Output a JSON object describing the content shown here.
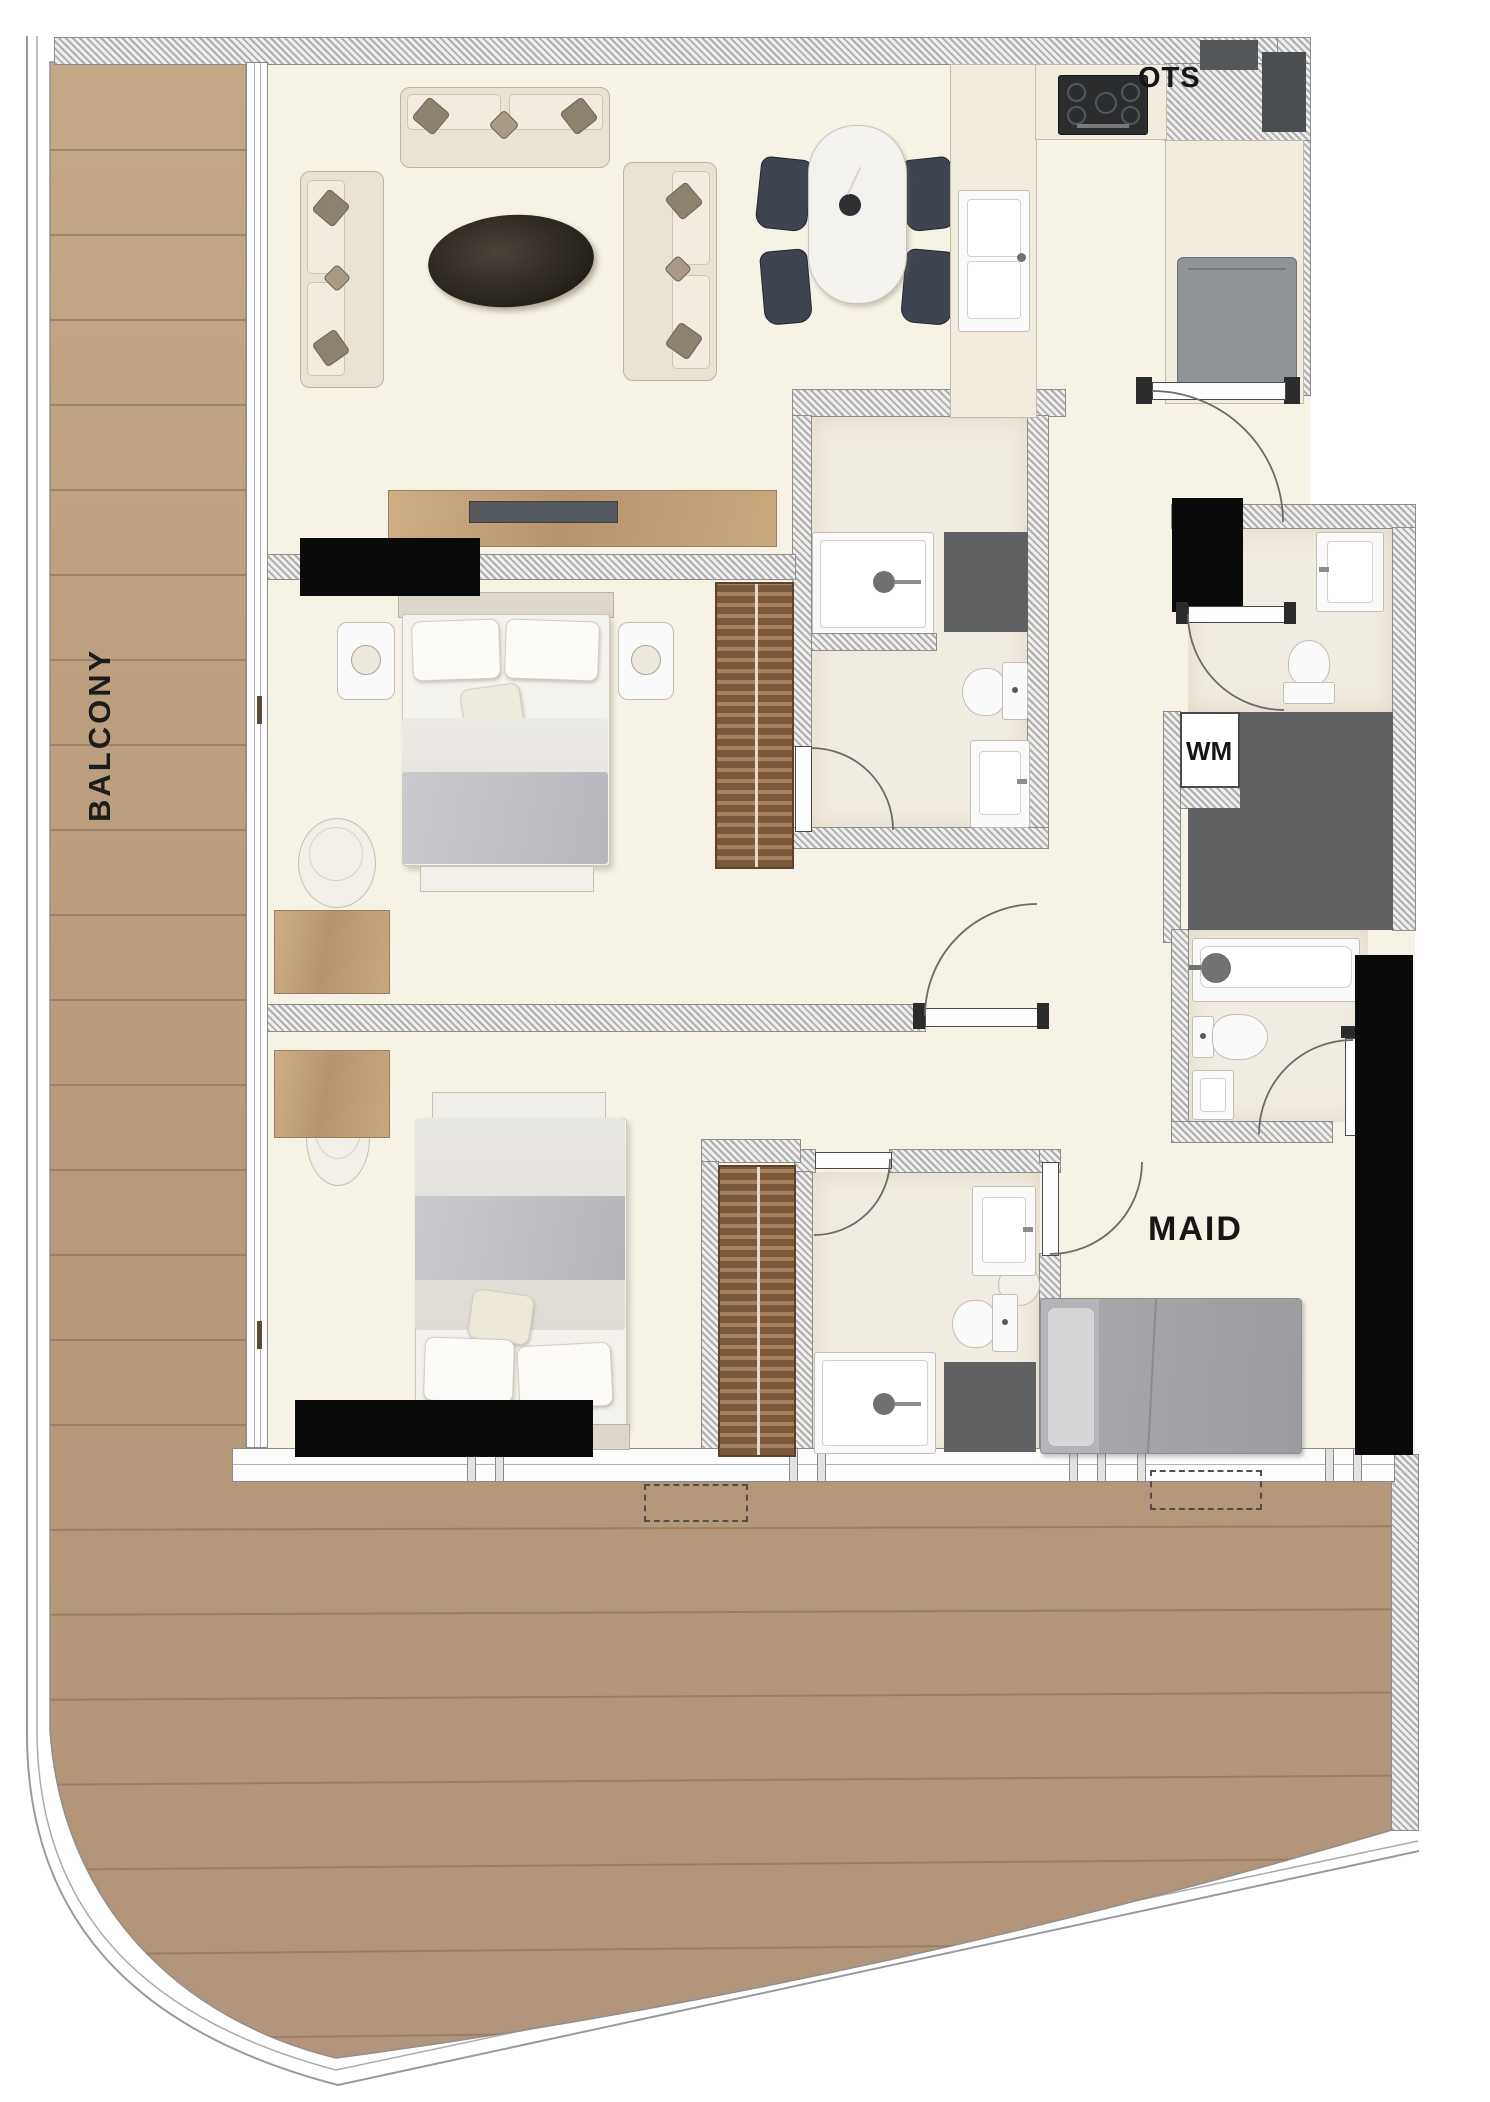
{
  "plan": {
    "title": "3-bedroom apartment floor plan with balcony",
    "labels": {
      "balcony": "BALCONY",
      "ots": "OTS",
      "wm": "WM",
      "maid": "MAID"
    },
    "colors": {
      "background": "#ffffff",
      "interior_floor": "#f6f2e6",
      "bathroom_floor": "#f1ece1",
      "wall_hatch_light": "#efeeec",
      "wall_hatch_dark": "#aeaeae",
      "wood_deck": "#b99c7c",
      "wood_plank_line": "#8a7156",
      "wood_furniture": "#c8a97f",
      "wardrobe_wood": "#8a6341",
      "sofa_beige": "#e9e3d6",
      "accent_cushion": "#8d8170",
      "coffee_table_dark": "#35302a",
      "dining_chair_dark": "#3d4450",
      "bed_blanket_gray": "#c3c5c9",
      "maid_bed_gray": "#b4b5b8",
      "appliance_gray": "#8f9496",
      "block_dark_gray": "#5f6163",
      "block_black": "#0a0a0a",
      "fixture_white": "#fbfafa",
      "door_arc_gray": "#6a6a6a"
    }
  }
}
